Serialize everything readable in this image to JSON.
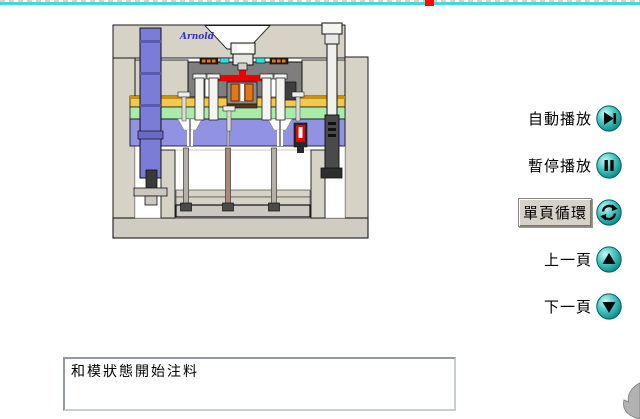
{
  "window": {
    "width": 640,
    "height": 419,
    "background": "#ffffff"
  },
  "top_edge": {
    "line_color": "#38dede",
    "marker_color": "#ee1100",
    "dash_color": "#f2c6c6"
  },
  "diagram": {
    "brand": "Arnold",
    "subject": "injection-mold-cross-section-animation-frame",
    "palette": {
      "plate_gray": "#d6d2c6",
      "manifold_gray": "#7e7e7e",
      "guide_pillar_purple": "#7b7bd8",
      "core_plate_purple": "#9292e2",
      "heater_plate_yellow": "#f2c94c",
      "yellow_top_edge": "#c79010",
      "cooling_plate_green": "#a9eba9",
      "melt_red": "#ee0000",
      "accent_cyan": "#2ae0e0",
      "nozzle_orange": "#e07818",
      "dark_steel": "#3c3c3c",
      "outline": "#1a1a1a"
    }
  },
  "controls": {
    "icon_teal": "#00a8a8",
    "items": [
      {
        "label": "自動播放",
        "icon": "play-icon",
        "selected": false
      },
      {
        "label": "暫停播放",
        "icon": "pause-icon",
        "selected": false
      },
      {
        "label": "單頁循環",
        "icon": "loop-icon",
        "selected": true
      },
      {
        "label": "上一頁",
        "icon": "up-icon",
        "selected": false
      },
      {
        "label": "下一頁",
        "icon": "down-icon",
        "selected": false
      }
    ]
  },
  "status_box": {
    "text": "和模狀態開始注料"
  }
}
